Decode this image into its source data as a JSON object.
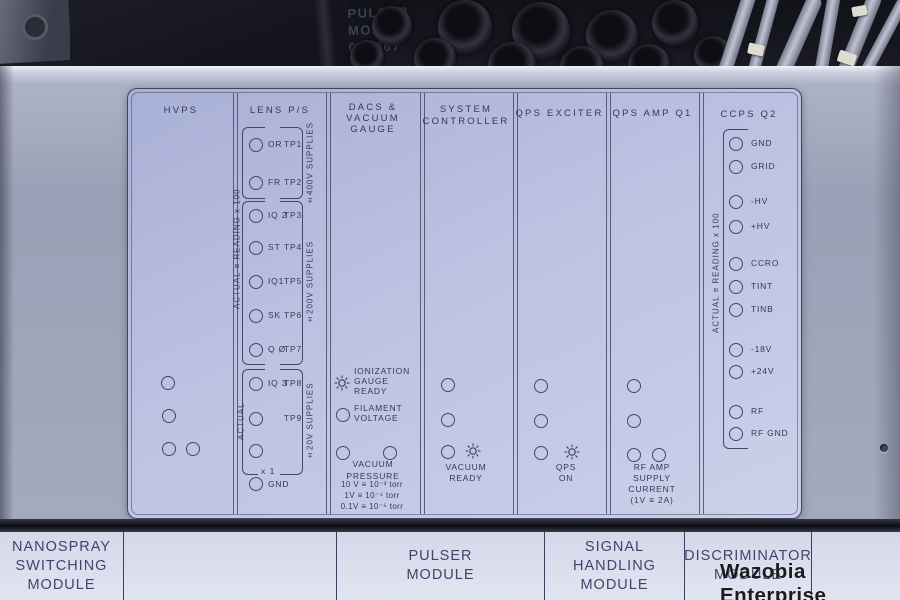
{
  "photo": {
    "stamp": "PULSER\nMODULE\n005967"
  },
  "columns": {
    "hvps": {
      "title": "HVPS"
    },
    "lens": {
      "title": "LENS P/S",
      "actual_reading": "ACTUAL ≡ READING x 100",
      "actual": "ACTUAL",
      "x1": "x 1",
      "gnd": "GND",
      "supplies_400": "±400V SUPPLIES",
      "supplies_200": "±200V SUPPLIES",
      "supplies_20": "±20V SUPPLIES",
      "tps": [
        {
          "name": "OR",
          "tp": "TP1"
        },
        {
          "name": "FR",
          "tp": "TP2"
        },
        {
          "name": "IQ 2",
          "tp": "TP3"
        },
        {
          "name": "ST",
          "tp": "TP4"
        },
        {
          "name": "IQ1",
          "tp": "TP5"
        },
        {
          "name": "SK",
          "tp": "TP6"
        },
        {
          "name": "Q Ø",
          "tp": "TP7"
        },
        {
          "name": "IQ 3",
          "tp": "TP8"
        },
        {
          "name": "",
          "tp": "TP9"
        },
        {
          "name": "",
          "tp": ""
        }
      ]
    },
    "dacs": {
      "title": "DACS &\nVACUUM GAUGE",
      "ionization": "IONIZATION\nGAUGE\nREADY",
      "filament": "FILAMENT\nVOLTAGE",
      "vacuum_pressure": "VACUUM\nPRESSURE",
      "scale": [
        "10 V ≡ 10⁻³ torr",
        "1V ≡ 10⁻⁴ torr",
        "0.1V ≡ 10⁻⁵ torr"
      ]
    },
    "system": {
      "title": "SYSTEM\nCONTROLLER",
      "vacuum_ready": "VACUUM\nREADY"
    },
    "exciter": {
      "title": "QPS EXCITER",
      "qps_on": "QPS\nON"
    },
    "amp": {
      "title": "QPS AMP Q1",
      "rf_amp": "RF AMP\nSUPPLY\nCURRENT\n(1V ≡ 2A)"
    },
    "ccps": {
      "title": "CCPS Q2",
      "actual_reading": "ACTUAL ≡ READING x 100",
      "points": [
        "GND",
        "GRID",
        "-HV",
        "+HV",
        "CCRO",
        "TINT",
        "TINB",
        "-18V",
        "+24V",
        "RF",
        "RF GND"
      ]
    }
  },
  "footer": {
    "cells": [
      "NANOSPRAY\nSWITCHING\nMODULE",
      "",
      "PULSER\nMODULE",
      "SIGNAL\nHANDLING\nMODULE",
      "DISCRIMINATOR\nMODULE",
      ""
    ]
  },
  "watermark": "Wazobia Enterprise"
}
